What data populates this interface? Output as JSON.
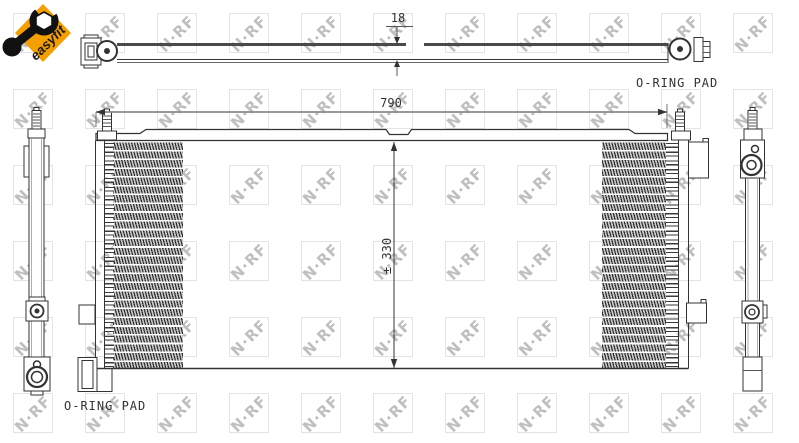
{
  "badge": {
    "label": "easyfit",
    "bg_color": "#F59E00",
    "icon": "wrench-icon"
  },
  "watermark": {
    "text": "N·RF",
    "rows": 6,
    "cols": 12
  },
  "top_view": {
    "thickness_dim": "18",
    "oring_pad_label": "O-RING PAD"
  },
  "front_view": {
    "width_dim": "790",
    "height_dim": "± 330",
    "oring_pad_label": "O-RING PAD"
  }
}
